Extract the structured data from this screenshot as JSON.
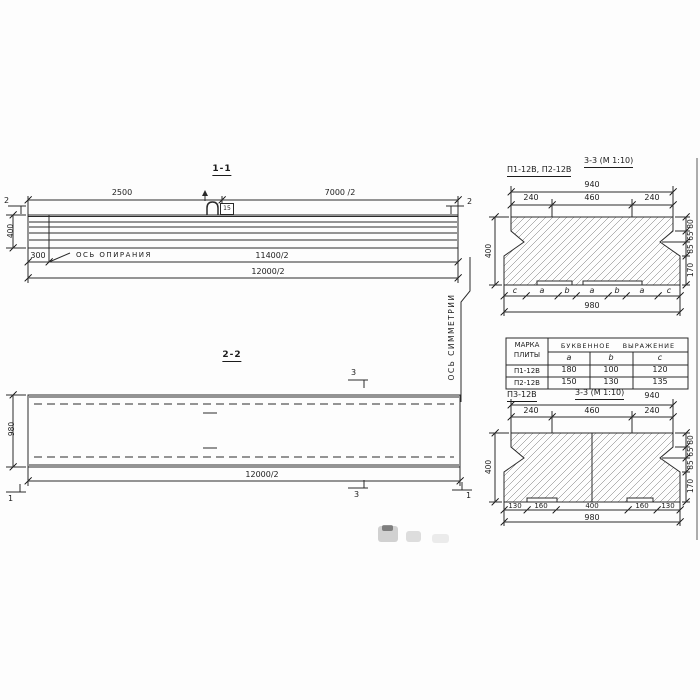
{
  "drawing": {
    "view_1_1": {
      "title": "1-1",
      "dim_2500": "2500",
      "dim_7000_2": "7000 /2",
      "dim_400": "400",
      "dim_300": "300",
      "support_axis_label": "ОСЬ ОПИРАНИЯ",
      "dim_11400_2": "11400/2",
      "dim_12000_2": "12000/2",
      "section_mark_2": "2",
      "loop_mark": "15"
    },
    "symmetry_axis_label": "ОСЬ СИММЕТРИИ",
    "view_2_2": {
      "title": "2-2",
      "dim_980": "980",
      "dim_12000_2": "12000/2",
      "section_mark_3": "3",
      "section_mark_1": "1"
    },
    "section_p1_p2": {
      "label": "П1-12В, П2-12В",
      "title": "3-3 (М 1:10)",
      "dim_940": "940",
      "dim_240_left": "240",
      "dim_460": "460",
      "dim_240_right": "240",
      "dim_400": "400",
      "right_dims": [
        "80",
        "65",
        "85",
        "170"
      ],
      "letter_row": [
        "c",
        "a",
        "b",
        "a",
        "b",
        "a",
        "c"
      ],
      "dim_980": "980"
    },
    "table": {
      "col1_line1": "МАРКА",
      "col1_line2": "ПЛИТЫ",
      "group_header": "БУКВЕННОЕ ВЫРАЖЕНИЕ",
      "columns": [
        "a",
        "b",
        "c"
      ],
      "rows": [
        {
          "mark": "П1-12В",
          "a": "180",
          "b": "100",
          "c": "120"
        },
        {
          "mark": "П2-12В",
          "a": "150",
          "b": "130",
          "c": "135"
        }
      ]
    },
    "section_p3": {
      "label": "П3-12В",
      "title": "3-3 (М 1:10)",
      "dim_940": "940",
      "dim_240_left": "240",
      "dim_460": "460",
      "dim_240_right": "240",
      "dim_400": "400",
      "right_dims": [
        "80",
        "65",
        "85",
        "170"
      ],
      "bottom_dims": [
        "130",
        "160",
        "400",
        "160",
        "130"
      ],
      "dim_980": "980"
    }
  }
}
